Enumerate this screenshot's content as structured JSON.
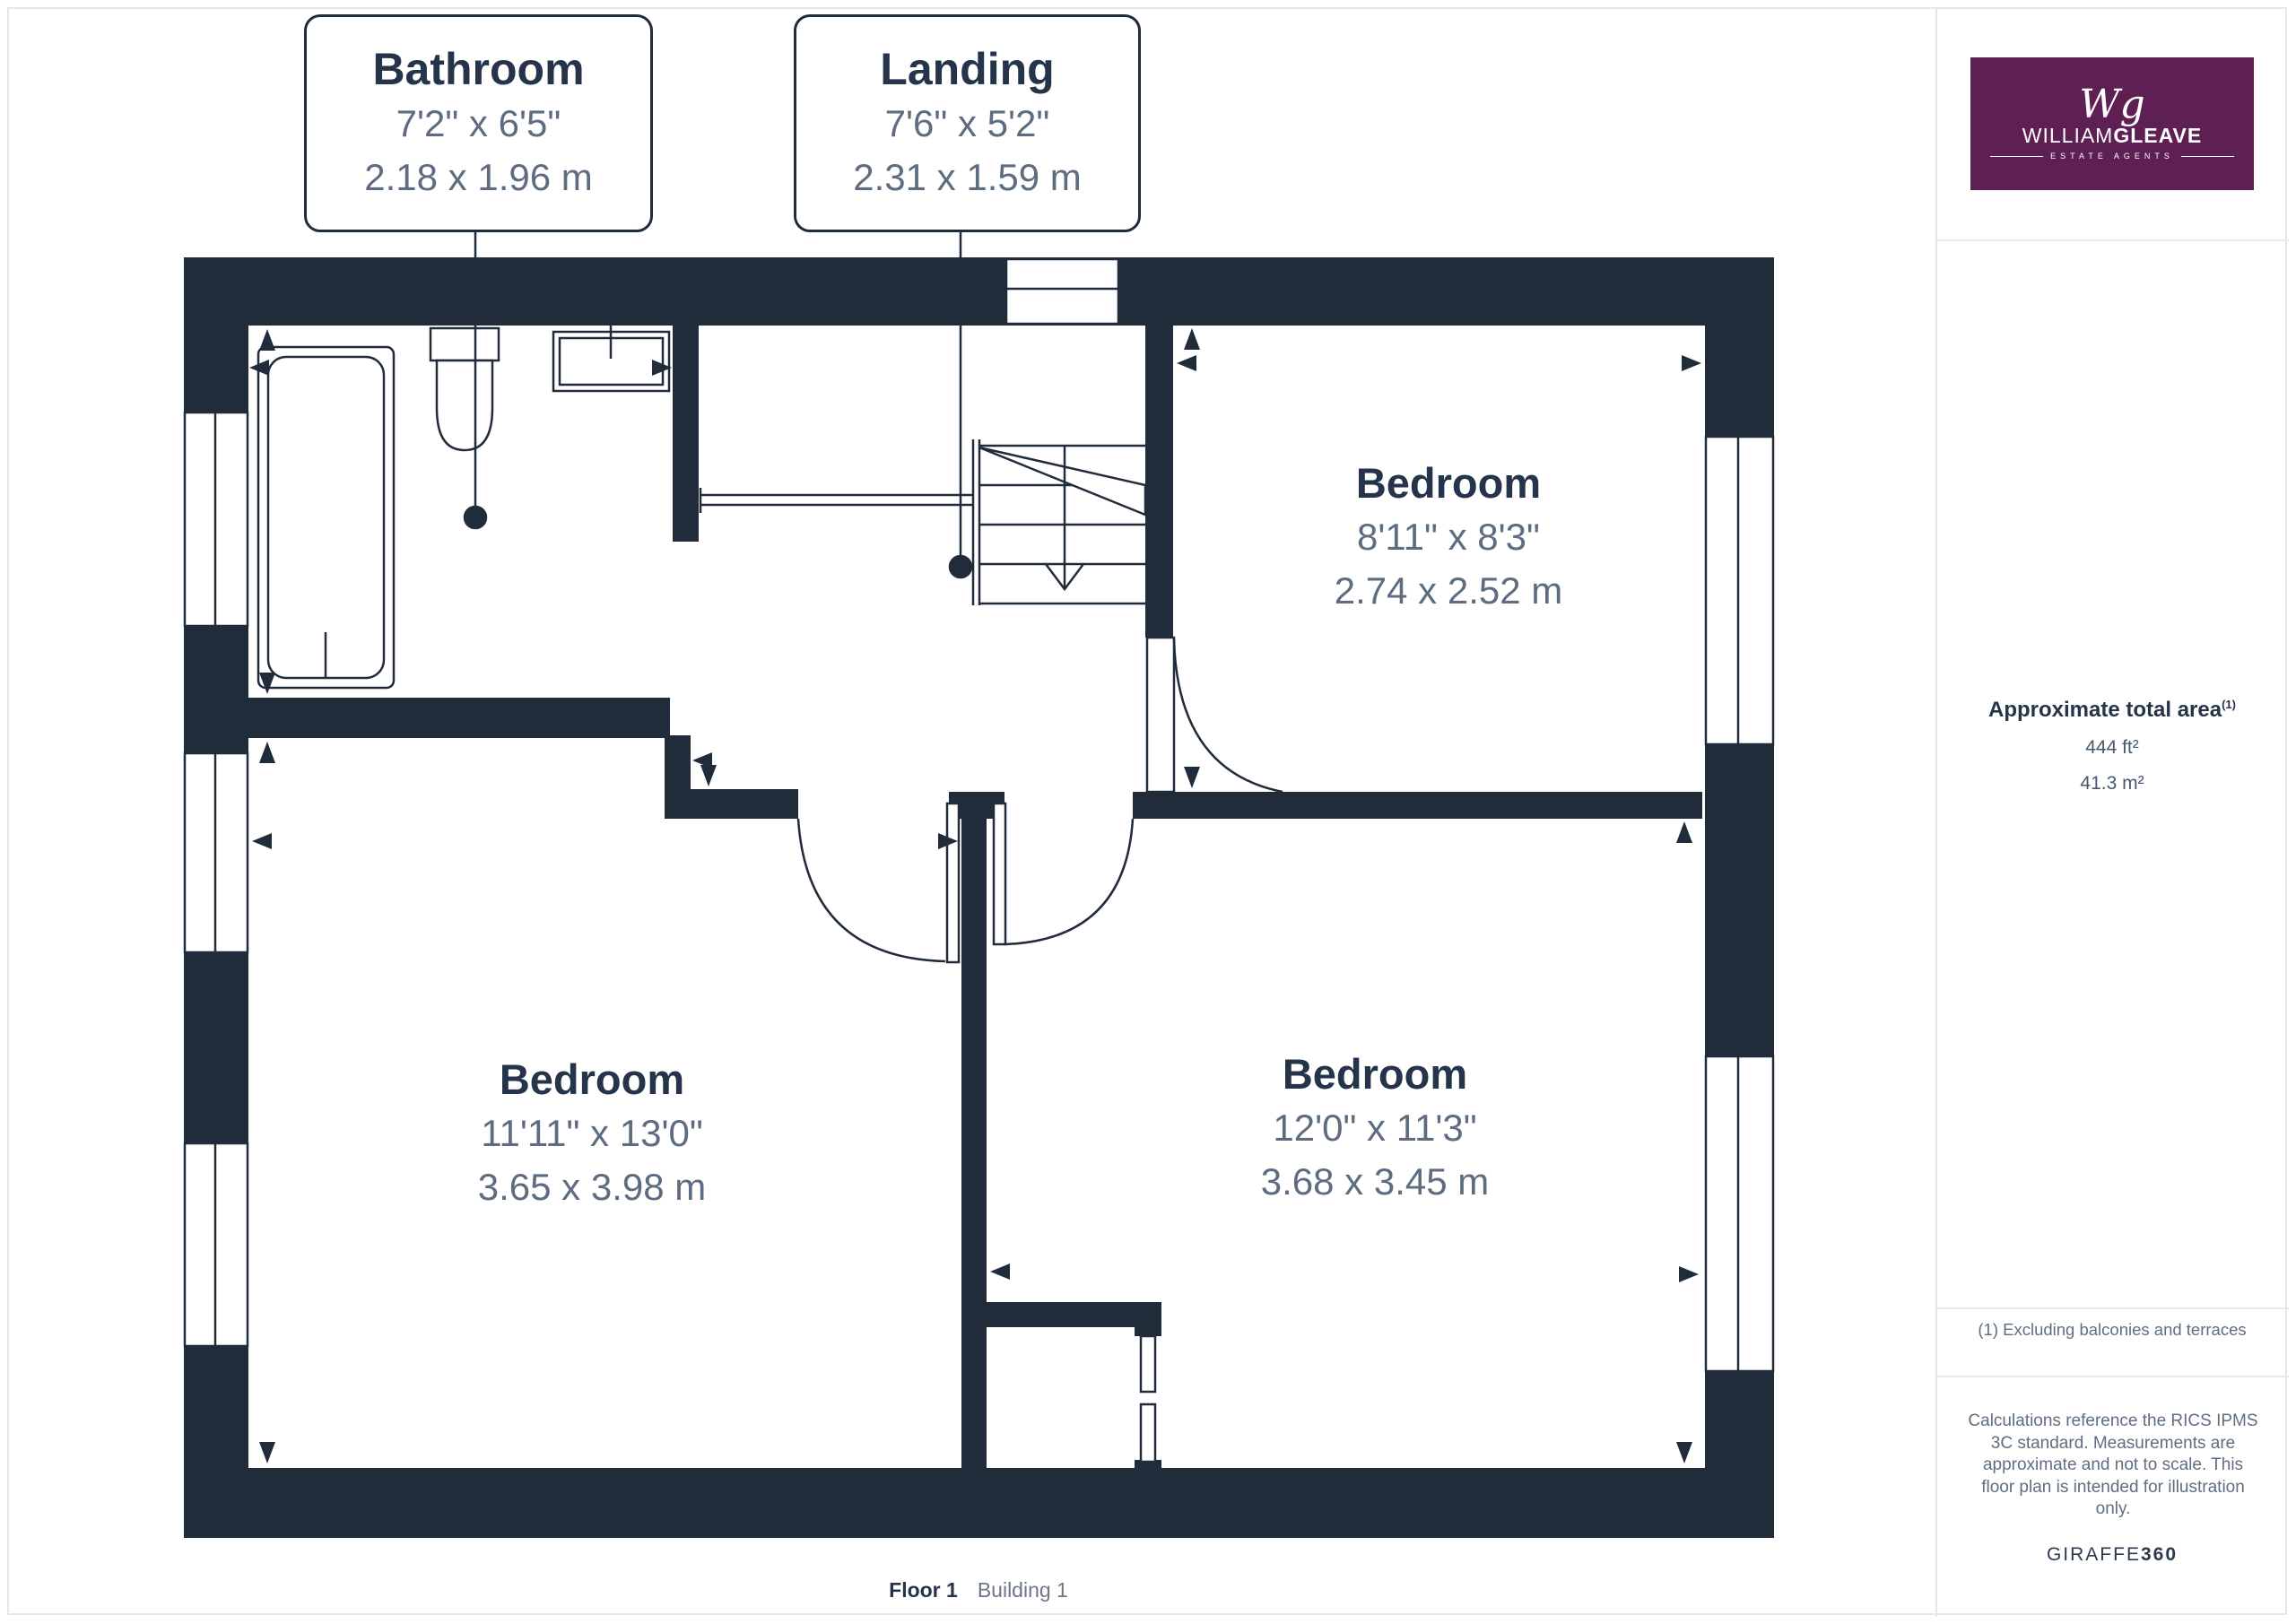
{
  "colors": {
    "wall": "#212c3b",
    "room_title_text": "#25344a",
    "dimension_text": "#5d6c80",
    "logo_background": "#5e1f52",
    "muted_text": "#5f6e80"
  },
  "callouts": [
    {
      "name": "Bathroom",
      "imperial": "7'2\" x 6'5\"",
      "metric": "2.18 x 1.96 m"
    },
    {
      "name": "Landing",
      "imperial": "7'6\" x 5'2\"",
      "metric": "2.31 x 1.59 m"
    }
  ],
  "rooms": [
    {
      "name": "Bedroom",
      "imperial": "8'11\" x 8'3\"",
      "metric": "2.74 x 2.52 m"
    },
    {
      "name": "Bedroom",
      "imperial": "11'11\" x 13'0\"",
      "metric": "3.65 x 3.98 m"
    },
    {
      "name": "Bedroom",
      "imperial": "12'0\" x 11'3\"",
      "metric": "3.68 x 3.45 m"
    }
  ],
  "caption": {
    "floor": "Floor 1",
    "building": "Building 1"
  },
  "logo": {
    "monogram": "Wg",
    "name_light": "WILLIAM",
    "name_bold": "GLEAVE",
    "tagline": "ESTATE AGENTS"
  },
  "sidebar": {
    "area_heading": "Approximate total area",
    "area_heading_note": "(1)",
    "area_imperial": "444 ft²",
    "area_metric": "41.3 m²",
    "footnote": "(1) Excluding balconies and terraces",
    "disclaimer_lines": [
      "Calculations reference the RICS IPMS",
      "3C standard. Measurements are",
      "approximate and not to scale. This",
      "floor plan is intended for illustration",
      "only."
    ],
    "brand": "GIRAFFE",
    "brand_bold": "360"
  }
}
